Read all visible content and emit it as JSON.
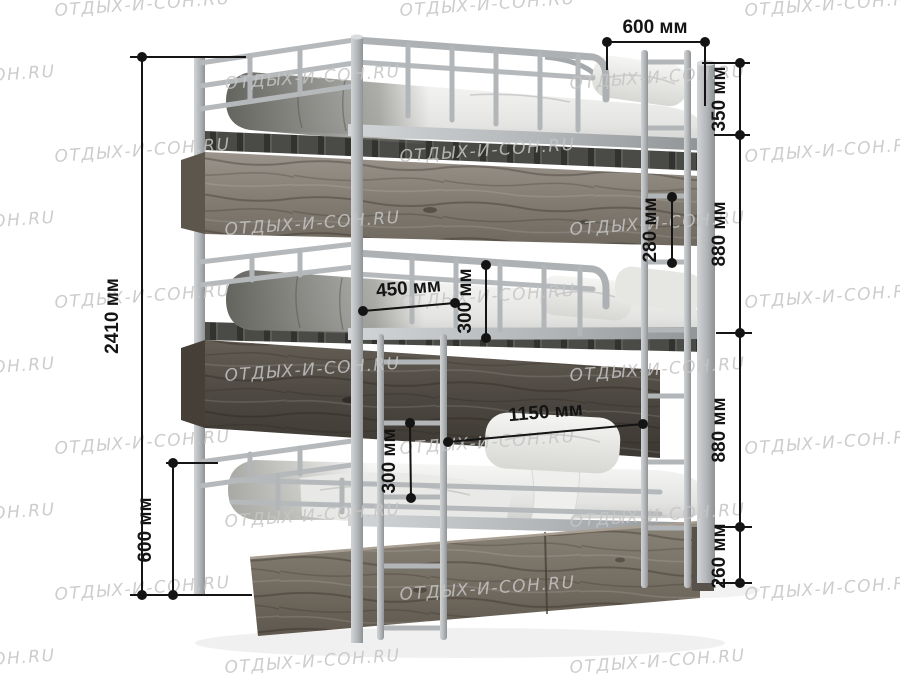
{
  "watermark": {
    "text": "ОТДЫХ-И-СОН.RU",
    "color": "#c5c5c5"
  },
  "product": {
    "name": "Кровать трехъярусная"
  },
  "labels": {
    "d2410": "2410 мм",
    "d600_left": "600 мм",
    "d600_top": "600 мм",
    "d350": "350 мм",
    "d880_upper": "880 мм",
    "d880_lower": "880 мм",
    "d260": "260 мм",
    "d280": "280 мм",
    "d450": "450 мм",
    "d300_middle": "300 мм",
    "d1150": "1150 мм",
    "d300_bottom": "300 мм"
  },
  "colors": {
    "dimension": "#141414",
    "metal": "#b4b7b9",
    "wood_light": "#8d8679",
    "wood_dark": "#534e46",
    "mattress": "#f4f4f2",
    "watermark": "#c5c5c5",
    "background": "#ffffff"
  }
}
